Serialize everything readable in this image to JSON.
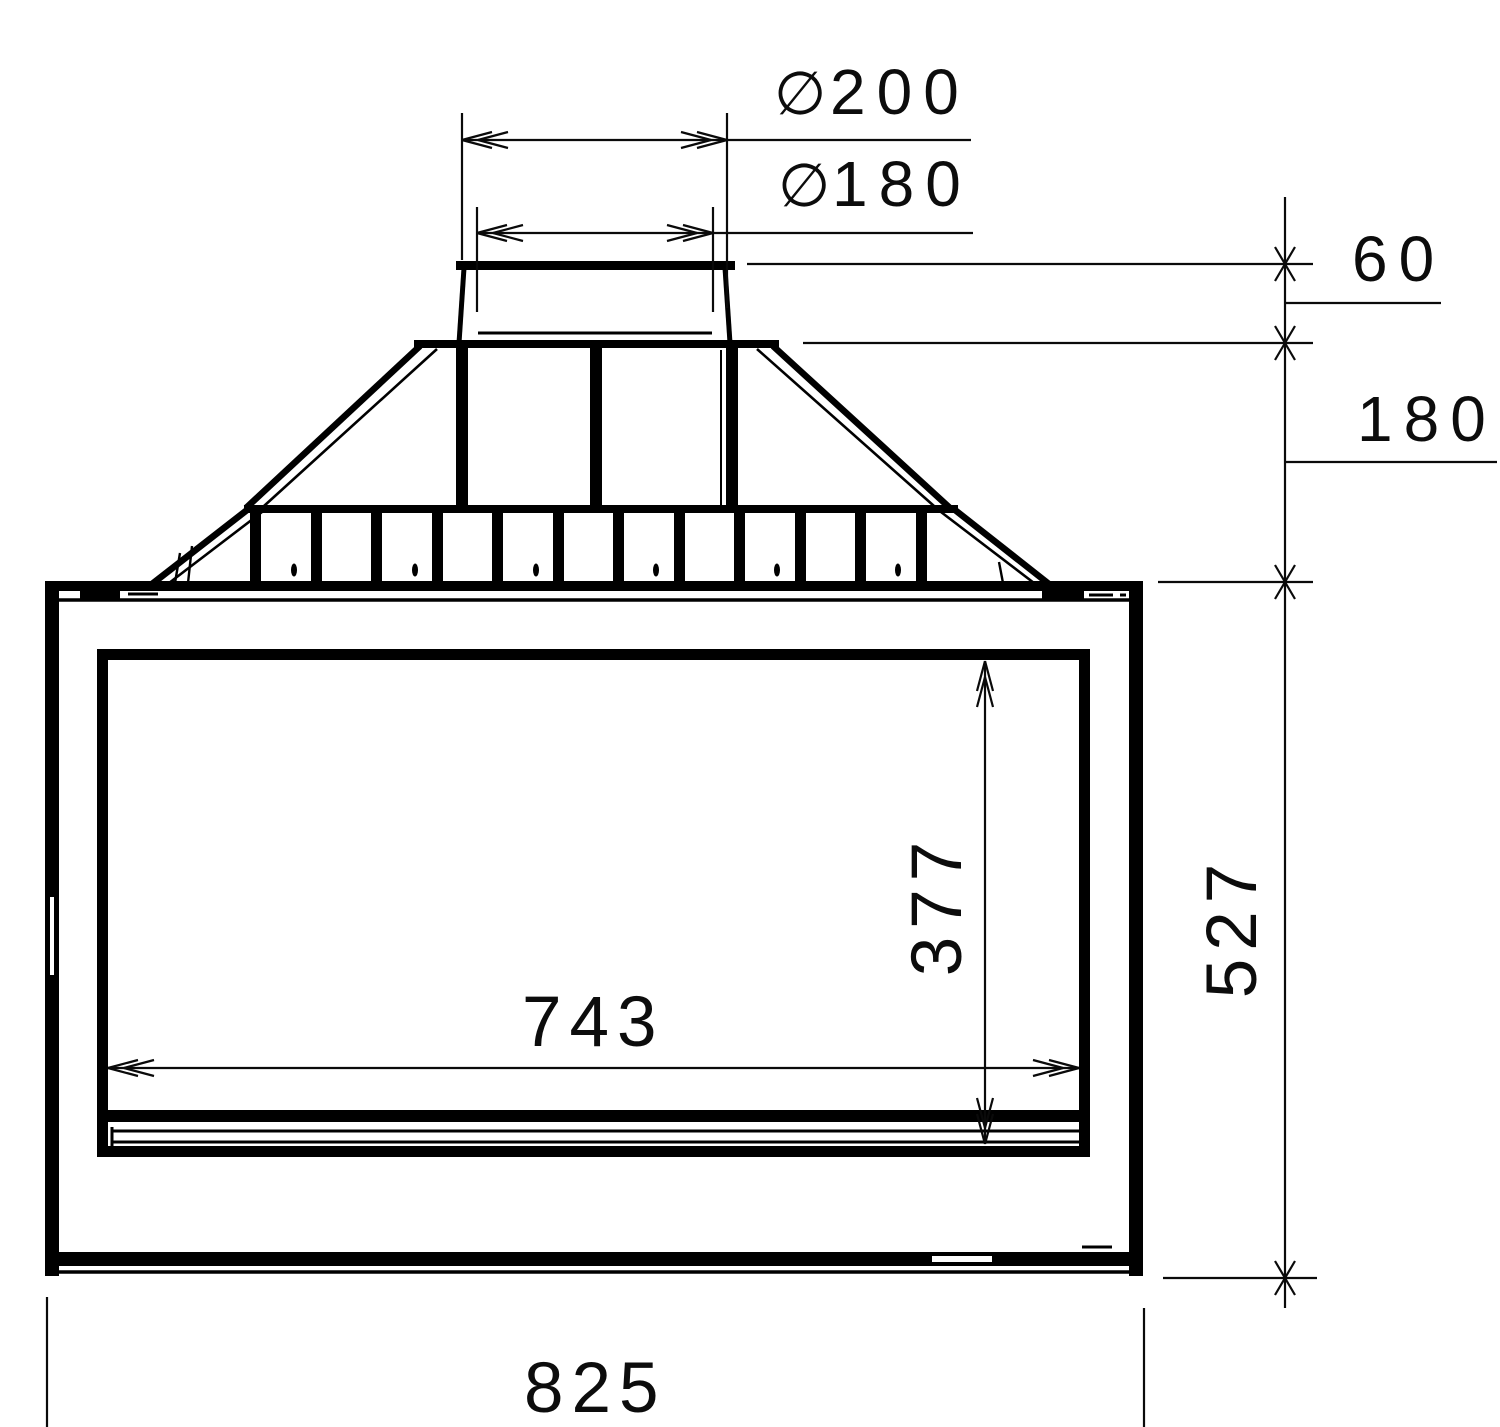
{
  "drawing": {
    "type": "technical-dimension-drawing",
    "line_color": "#000000",
    "background": "#ffffff"
  },
  "labels": {
    "flue_outer_diameter": {
      "symbol": "∅",
      "value": "200"
    },
    "flue_inner_diameter": {
      "symbol": "∅",
      "value": "180"
    },
    "collar_height": "60",
    "hood_height": "180",
    "body_height": "527",
    "glass_height": "377",
    "glass_width": "743",
    "overall_width": "825"
  }
}
